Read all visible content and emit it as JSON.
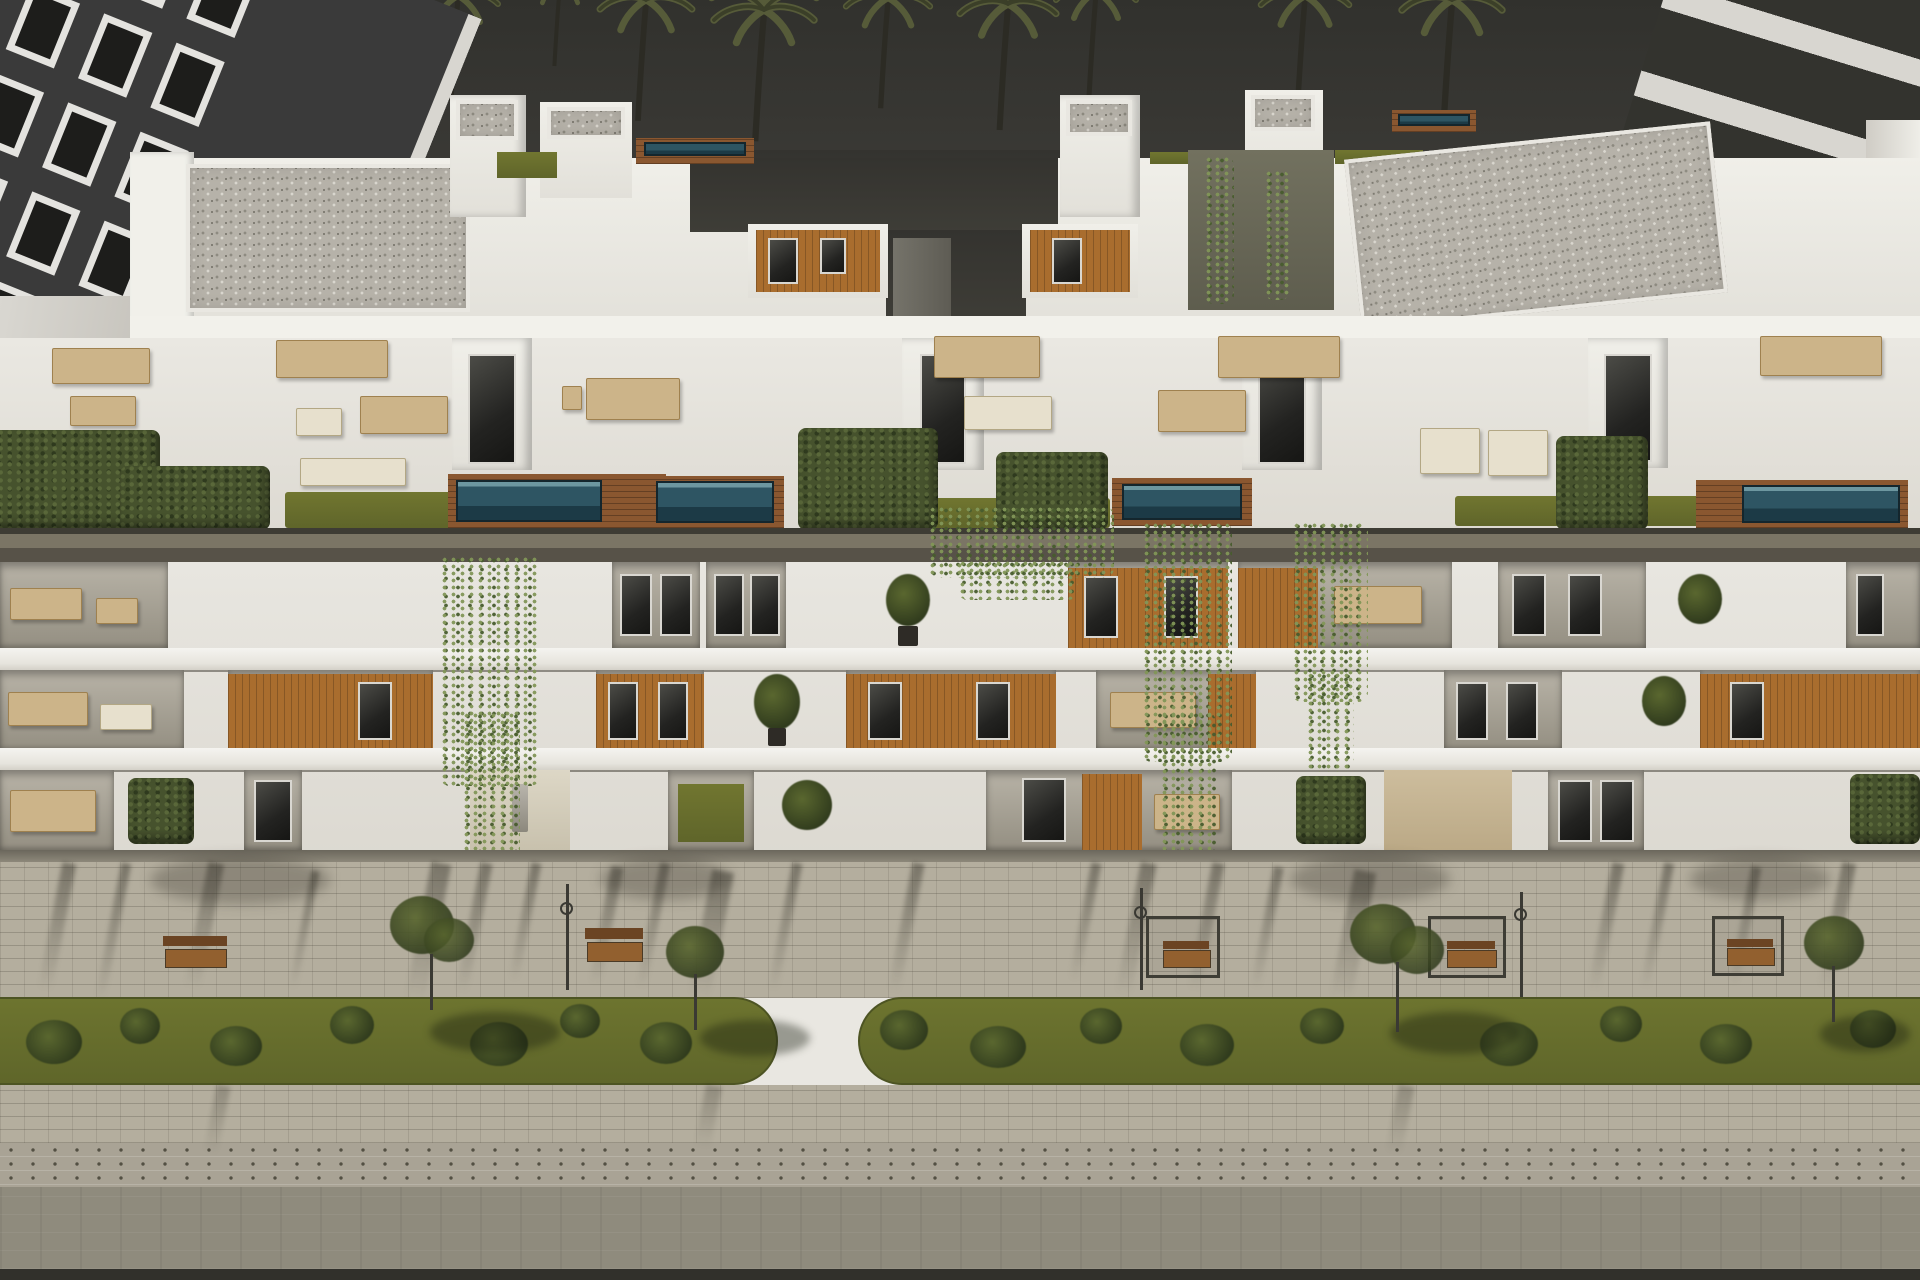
{
  "meta": {
    "type": "architectural-3d-rendering",
    "subject": "Aerial dusk view of a modern white apartment complex with rooftop penthouse terraces, plunge pools, timber-clad balconies, hanging vines and a landscaped paved promenade with benches and planting strips",
    "visible_text": "none"
  },
  "palette": {
    "sky": "#38372f",
    "white": "#e9e7e1",
    "white-bright": "#f4f3ef",
    "wood": "#a96d2e",
    "deck": "#8a5730",
    "pool": "#2e5563",
    "lawn": "#6c7230",
    "hedge": "#46522d",
    "tan": "#ccb489",
    "cornice": "#6f6a5c",
    "pavement": "#b4ae9e",
    "road": "#8f8b7d",
    "planting-strip": "#666d2c",
    "neighbor-dark": "#3a3a3a"
  },
  "scene": {
    "background": [
      "dark dusk sky",
      "row of palm trees"
    ],
    "left_neighbor": "dark multi-storey building with white window frames",
    "right_neighbor": "light building with dark glass balcony bands",
    "main_building": [
      "roof level with gravel flat roofs, white stair towers, lap-pool strips, lawn patches and ivy wall",
      "penthouse terrace level with plunge pools, timber decks, lounge furniture and hedges",
      "three balcony floors with timber panelling, glass doors, potted plants and cascading vines",
      "street-level patios"
    ],
    "street": [
      "paved promenade with long tree shadows",
      "wooden benches and pergola seats",
      "street lamps",
      "green planting strips with shrubs and young trees",
      "dotted paver band and roadway"
    ],
    "counts": {
      "palm_trees": 12,
      "roof_strip_pools": 2,
      "terrace_plunge_pools": 4,
      "benches": 5,
      "pergolas": 3,
      "street_lamps": 3,
      "street_trees": 4
    }
  }
}
